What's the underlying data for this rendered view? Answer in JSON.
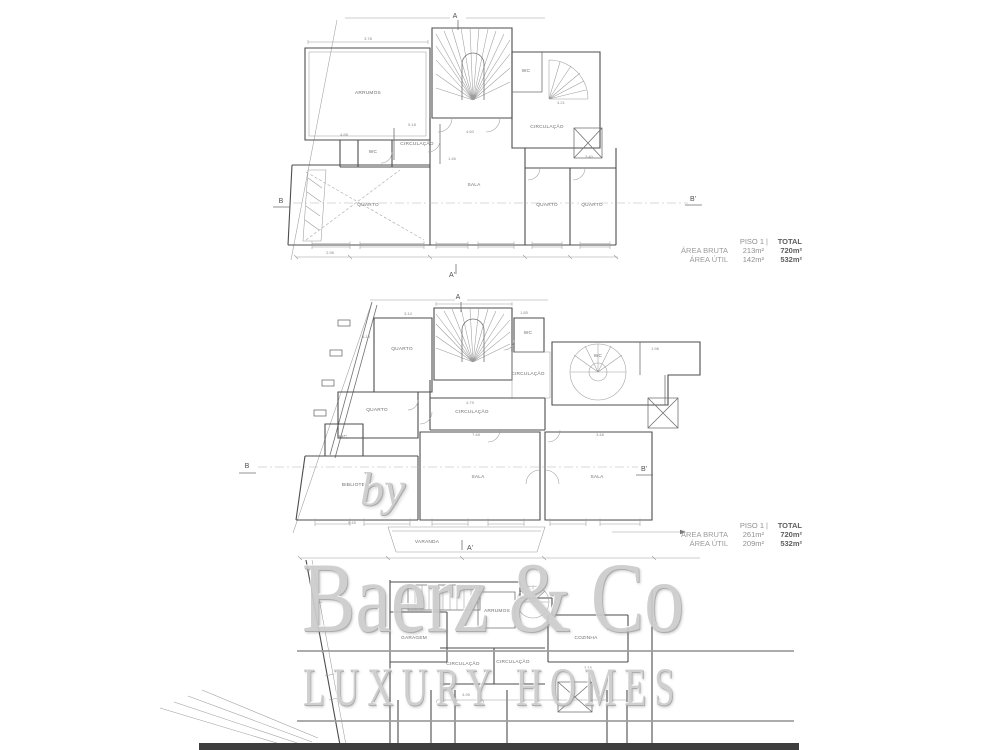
{
  "colors": {
    "background": "#ffffff",
    "wall_line": "#4d4d4d",
    "light_line": "#9c9c9c",
    "watermark_gray": "#cccccc",
    "rule_gray": "#9d9d9d",
    "footer_bar": "#3e3e3e",
    "table_label": "#9b9b9b",
    "table_total": "#5e5e5e"
  },
  "watermark": {
    "by": "by",
    "brand": "Baerz & Co",
    "tagline": "LUXURY HOMES"
  },
  "tables": [
    {
      "header_left": "PISO 1",
      "header_divider": "|",
      "header_right": "TOTAL",
      "rows": [
        {
          "label": "ÁREA BRUTA",
          "value": "213m²",
          "total": "720m²"
        },
        {
          "label": "ÁREA ÚTIL",
          "value": "142m²",
          "total": "532m²"
        }
      ]
    },
    {
      "header_left": "PISO 1",
      "header_divider": "|",
      "header_right": "TOTAL",
      "rows": [
        {
          "label": "ÁREA BRUTA",
          "value": "261m²",
          "total": "720m²"
        },
        {
          "label": "ÁREA ÚTIL",
          "value": "209m²",
          "total": "532m²"
        }
      ]
    }
  ],
  "plans": [
    {
      "id": "upper-floor-plan",
      "rooms": [
        {
          "label": "ARRUMOS",
          "x": 368,
          "y": 94
        },
        {
          "label": "CIRCULAÇÃO",
          "x": 417,
          "y": 145
        },
        {
          "label": "WC",
          "x": 373,
          "y": 153
        },
        {
          "label": "WC",
          "x": 526,
          "y": 72
        },
        {
          "label": "CIRCULAÇÃO",
          "x": 547,
          "y": 128
        },
        {
          "label": "QUARTO",
          "x": 368,
          "y": 206
        },
        {
          "label": "SALA",
          "x": 474,
          "y": 186
        },
        {
          "label": "QUARTO",
          "x": 547,
          "y": 206
        },
        {
          "label": "QUARTO",
          "x": 592,
          "y": 206
        }
      ],
      "dims": [
        {
          "t": "3.78",
          "x": 368,
          "y": 40
        },
        {
          "t": "4.88",
          "x": 344,
          "y": 136
        },
        {
          "t": "5.18",
          "x": 412,
          "y": 126
        },
        {
          "t": "4.60",
          "x": 470,
          "y": 133
        },
        {
          "t": "4.21",
          "x": 561,
          "y": 104
        },
        {
          "t": "3.40",
          "x": 589,
          "y": 158
        },
        {
          "t": "1.46",
          "x": 452,
          "y": 160
        },
        {
          "t": "2.98",
          "x": 330,
          "y": 254
        }
      ],
      "markers": [
        {
          "t": "A",
          "x": 455,
          "y": 18
        },
        {
          "t": "A'",
          "x": 452,
          "y": 277
        },
        {
          "t": "B",
          "x": 281,
          "y": 203
        },
        {
          "t": "B'",
          "x": 693,
          "y": 201
        }
      ]
    },
    {
      "id": "main-floor-plan",
      "rooms": [
        {
          "label": "QUARTO",
          "x": 402,
          "y": 350
        },
        {
          "label": "WC",
          "x": 528,
          "y": 334
        },
        {
          "label": "CIRCULAÇÃO",
          "x": 528,
          "y": 375
        },
        {
          "label": "WC",
          "x": 598,
          "y": 357
        },
        {
          "label": "CIRCULAÇÃO",
          "x": 472,
          "y": 413
        },
        {
          "label": "QUARTO",
          "x": 377,
          "y": 411
        },
        {
          "label": "WC",
          "x": 343,
          "y": 438
        },
        {
          "label": "BIBLIOTECA",
          "x": 357,
          "y": 486
        },
        {
          "label": "SALA",
          "x": 478,
          "y": 478
        },
        {
          "label": "SALA",
          "x": 597,
          "y": 478
        },
        {
          "label": "VARANDA",
          "x": 427,
          "y": 543
        }
      ],
      "dims": [
        {
          "t": "3.14",
          "x": 408,
          "y": 315
        },
        {
          "t": "1.85",
          "x": 524,
          "y": 314
        },
        {
          "t": "5.18",
          "x": 366,
          "y": 338
        },
        {
          "t": "1.98",
          "x": 655,
          "y": 350
        },
        {
          "t": "4.79",
          "x": 470,
          "y": 404
        },
        {
          "t": "7.48",
          "x": 476,
          "y": 436
        },
        {
          "t": "3.48",
          "x": 600,
          "y": 436
        },
        {
          "t": "5.45",
          "x": 352,
          "y": 524
        }
      ],
      "markers": [
        {
          "t": "A",
          "x": 458,
          "y": 299
        },
        {
          "t": "A'",
          "x": 470,
          "y": 550
        },
        {
          "t": "B",
          "x": 247,
          "y": 468
        },
        {
          "t": "B'",
          "x": 644,
          "y": 471
        }
      ]
    },
    {
      "id": "lower-floor-plan",
      "rooms": [
        {
          "label": "ARRUMOS",
          "x": 497,
          "y": 612
        },
        {
          "label": "GARAGEM",
          "x": 414,
          "y": 639
        },
        {
          "label": "CIRCULAÇÃO",
          "x": 463,
          "y": 665
        },
        {
          "label": "CIRCULAÇÃO",
          "x": 513,
          "y": 663
        },
        {
          "label": "COZINHA",
          "x": 586,
          "y": 639
        }
      ],
      "dims": [
        {
          "t": "4.95",
          "x": 466,
          "y": 696
        },
        {
          "t": "3.16",
          "x": 588,
          "y": 669
        },
        {
          "t": "2.08",
          "x": 611,
          "y": 630
        }
      ],
      "markers": []
    }
  ]
}
